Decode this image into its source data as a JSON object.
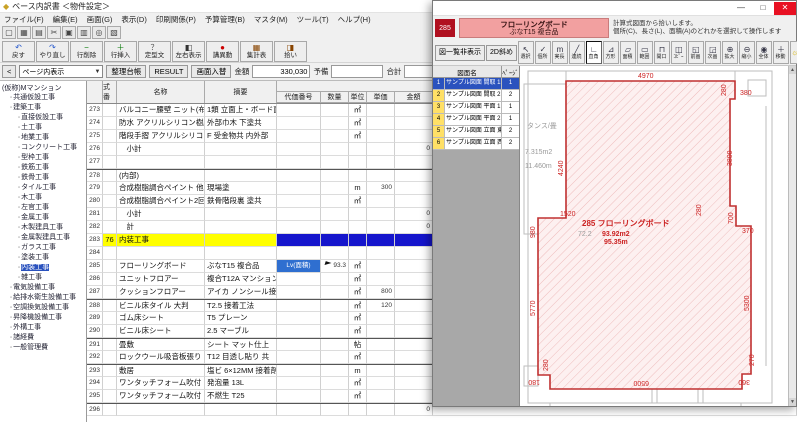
{
  "left_window": {
    "title": "ベース内訳書 ＜物件設定＞",
    "menu": [
      "ファイル(F)",
      "編集(E)",
      "画面(G)",
      "表示(D)",
      "印刷関係(P)",
      "予算管理(B)",
      "マスタ(M)",
      "ツール(T)",
      "ヘルプ(H)"
    ],
    "toolbar1": [
      {
        "icon": "new-icon",
        "g": "▢"
      },
      {
        "icon": "save-icon",
        "g": "▦"
      },
      {
        "icon": "print-icon",
        "g": "▤"
      },
      {
        "icon": "cut-icon",
        "g": "✂"
      },
      {
        "icon": "copy-icon",
        "g": "▣"
      },
      {
        "icon": "paste-icon",
        "g": "▥"
      },
      {
        "icon": "find-icon",
        "g": "◎"
      },
      {
        "icon": "filter-icon",
        "g": "▧"
      }
    ],
    "toolbar2": [
      {
        "g": "↶",
        "t": "戻す",
        "c": "#2255cc"
      },
      {
        "g": "↷",
        "t": "やり直し",
        "c": "#2255cc"
      },
      {
        "g": "−",
        "t": "行削除",
        "c": "#007700"
      },
      {
        "g": "＋",
        "t": "行挿入",
        "c": "#007700"
      },
      {
        "g": "？",
        "t": "定型文",
        "c": "#555555"
      },
      {
        "g": "◧",
        "t": "左右表示",
        "c": "#333333"
      },
      {
        "g": "●",
        "t": "講異動",
        "c": "#cc0000"
      },
      {
        "g": "▦",
        "t": "集計表",
        "c": "#884400"
      },
      {
        "g": "◨",
        "t": "拾い",
        "c": "#884400"
      }
    ],
    "nav": {
      "back": "<",
      "view_combo": "ページ内表示",
      "buttons": [
        "整理台帳",
        "RESULT",
        "画面入替"
      ],
      "field1_label": "金額",
      "field1_value": "330,030",
      "field2_label": "予備",
      "field2_value": "",
      "field3_label": "合計",
      "field3_value": "330,030",
      "percent": "%",
      "select_btn": "選択"
    },
    "tree": {
      "root": "(仮称)Mマンション",
      "node_icon": "▫",
      "items": [
        {
          "l": 1,
          "t": "共通仮設工事"
        },
        {
          "l": 1,
          "t": "建築工事"
        },
        {
          "l": 2,
          "t": "直接仮設工事"
        },
        {
          "l": 2,
          "t": "土工事"
        },
        {
          "l": 2,
          "t": "地業工事"
        },
        {
          "l": 2,
          "t": "コンクリート工事"
        },
        {
          "l": 2,
          "t": "型枠工事"
        },
        {
          "l": 2,
          "t": "鉄筋工事"
        },
        {
          "l": 2,
          "t": "鉄骨工事"
        },
        {
          "l": 2,
          "t": "タイル工事"
        },
        {
          "l": 2,
          "t": "木工事"
        },
        {
          "l": 2,
          "t": "左官工事"
        },
        {
          "l": 2,
          "t": "金属工事"
        },
        {
          "l": 2,
          "t": "木製建具工事"
        },
        {
          "l": 2,
          "t": "金属製建具工事"
        },
        {
          "l": 2,
          "t": "ガラス工事"
        },
        {
          "l": 2,
          "t": "塗装工事"
        },
        {
          "l": 2,
          "t": "内装工事",
          "sel": true
        },
        {
          "l": 2,
          "t": "雑工事"
        },
        {
          "l": 1,
          "t": "電気設備工事"
        },
        {
          "l": 1,
          "t": "給排水衛生設備工事"
        },
        {
          "l": 1,
          "t": "空調換気設備工事"
        },
        {
          "l": 1,
          "t": "昇降機設備工事"
        },
        {
          "l": 1,
          "t": "外構工事"
        },
        {
          "l": 1,
          "t": "諸経費"
        },
        {
          "l": 1,
          "t": "一般管理費"
        }
      ]
    },
    "table": {
      "h_shiki": "式番",
      "h_name": "名称",
      "h_spec": "摘要",
      "h_group": "明細内訳",
      "h_daika": "代価番号",
      "h_qty": "数量",
      "h_unit": "単位",
      "h_price": "単価",
      "h_amount": "金額",
      "h_biko": "備 考",
      "rows": [
        {
          "no": "273",
          "name": "バルコニー腰壁 ニット(布)張り",
          "spec": "1類 立面上・ボード面",
          "unit": "㎡"
        },
        {
          "no": "274",
          "name": "防水 アクリルシリコン樹脂",
          "spec": "外部巾木 下塗共",
          "unit": "㎡"
        },
        {
          "no": "275",
          "name": "階段手摺 アクリルシリコン樹脂",
          "spec": "F 受金物共 内外部",
          "unit": "㎡"
        },
        {
          "no": "276",
          "name": "　小計",
          "amount": "0"
        },
        {
          "no": "277"
        },
        {
          "no": "278",
          "name": "(内部)",
          "sep": true
        },
        {
          "no": "279",
          "name": "合成樹脂調合ペイント 他",
          "spec": "現場塗",
          "unit": "m",
          "price": "300"
        },
        {
          "no": "280",
          "name": "合成樹脂調合ペイント2回",
          "spec": "鉄骨階段裏 塗共",
          "unit": "㎡"
        },
        {
          "no": "281",
          "name": "　小計",
          "amount": "0"
        },
        {
          "no": "282",
          "name": "　計",
          "amount": "0"
        },
        {
          "no": "283",
          "shiki": "76",
          "name": "内装工事",
          "yellow": true
        },
        {
          "no": "284"
        },
        {
          "no": "285",
          "name": "フローリングボード",
          "spec": "ぶなT15 複合品",
          "daika": "Lv(面積)",
          "sel": true,
          "qty": "93.3",
          "unit": "㎡"
        },
        {
          "no": "286",
          "name": "ユニットフロアー",
          "spec": "複合T12A マンション用",
          "unit": "㎡"
        },
        {
          "no": "287",
          "name": "クッションフロアー",
          "spec": "アイカ ノンシール接着",
          "unit": "㎡",
          "price": "800"
        },
        {
          "no": "288",
          "name": "ビニル床タイル 大判",
          "spec": "T2.5 接着工法",
          "unit": "㎡",
          "price": "120",
          "sep": true
        },
        {
          "no": "289",
          "name": "ゴム床シート",
          "spec": "T5 プレーン",
          "unit": "㎡"
        },
        {
          "no": "290",
          "name": "ビニル床シート",
          "spec": "2.5 マーブル",
          "unit": "㎡"
        },
        {
          "no": "291",
          "name": "畳敷",
          "spec": "シート マット仕上",
          "unit": "帖",
          "sep": true
        },
        {
          "no": "292",
          "name": "ロックウール吸音板張り",
          "spec": "T12 目透し貼り 共",
          "unit": "㎡"
        },
        {
          "no": "293",
          "name": "敷居",
          "spec": "塩ビ 6×12MM 接着剤",
          "unit": "m",
          "sep": true
        },
        {
          "no": "294",
          "name": "ワンタッチフォーム吹付",
          "spec": "発泡量 13L",
          "unit": "㎡"
        },
        {
          "no": "295",
          "name": "ワンタッチフォーム吹付",
          "spec": "不燃生 T25",
          "unit": "㎡"
        },
        {
          "no": "296",
          "amount": "0",
          "sep": true
        }
      ]
    }
  },
  "right_window": {
    "controls": {
      "min": "—",
      "max": "□",
      "close": "✕"
    },
    "badge": "285",
    "item_title": "フローリングボード",
    "item_sub": "ぶなT15 複合品",
    "instr1": "計算式図面から拾いします。",
    "instr2": "個所(C)、長さ(L)、面積(A)のどれかを選択して操作します",
    "toolbar": {
      "list_toggle": "図一覧非表示",
      "mode_btn": "2D斜め",
      "tools": [
        {
          "g": "↖",
          "t": "選択"
        },
        {
          "g": "✓",
          "t": "個所"
        },
        {
          "g": "m",
          "t": "実長"
        },
        {
          "g": "╱",
          "t": "連続"
        },
        {
          "g": "∟",
          "t": "直角",
          "pressed": true
        },
        {
          "g": "⊿",
          "t": "方形"
        },
        {
          "g": "▱",
          "t": "面積"
        },
        {
          "g": "▭",
          "t": "範囲"
        },
        {
          "g": "⊓",
          "t": "開口"
        },
        {
          "g": "◫",
          "t": "ｺﾋﾟｰ"
        },
        {
          "g": "◱",
          "t": "前画"
        },
        {
          "g": "◲",
          "t": "次画"
        },
        {
          "g": "⊕",
          "t": "拡大"
        },
        {
          "g": "⊖",
          "t": "縮小"
        },
        {
          "g": "◉",
          "t": "全体"
        },
        {
          "g": "＋",
          "t": "移動"
        }
      ],
      "lamp_glyph": "☼",
      "scale_btn": "尺T",
      "cancel_btn": "中止"
    },
    "list": {
      "h_name": "図面名",
      "h_page": "ﾍﾟｰｼﾞ",
      "rows": [
        {
          "no": "1",
          "name": "サンプル図面 間取 1F.jww",
          "page": "1",
          "sel": true
        },
        {
          "no": "2",
          "name": "サンプル図面 間取 2F.jww",
          "page": "2"
        },
        {
          "no": "3",
          "name": "サンプル図面 平面 1F.jww",
          "page": "1"
        },
        {
          "no": "4",
          "name": "サンプル図面 平面 2F.jww",
          "page": "1"
        },
        {
          "no": "5",
          "name": "サンプル図面 立面 東.jww",
          "page": "2"
        },
        {
          "no": "6",
          "name": "サンプル図面 立面 西.jww",
          "page": "2"
        }
      ]
    },
    "drawing": {
      "dims": {
        "top": "4970",
        "tr_v": "280",
        "tr_h": "380",
        "right_v": "3800",
        "mid_v": "280",
        "step700": "700",
        "step370": "370",
        "left_upper": "4240",
        "left_980": "980",
        "left_1520": "1520",
        "left_lower": "5770",
        "right_lower": "5300",
        "bottom": "6500",
        "bl_v": "280",
        "bl_h": "180",
        "br_v": "270",
        "br_h": "360"
      },
      "center": {
        "title": "285 フローリングボード",
        "prev": "72.2",
        "area": "93.92m2",
        "len": "95.35m"
      },
      "room": {
        "name": "タンス/畳",
        "area": "7.315m2",
        "len": "11.460m"
      }
    }
  }
}
